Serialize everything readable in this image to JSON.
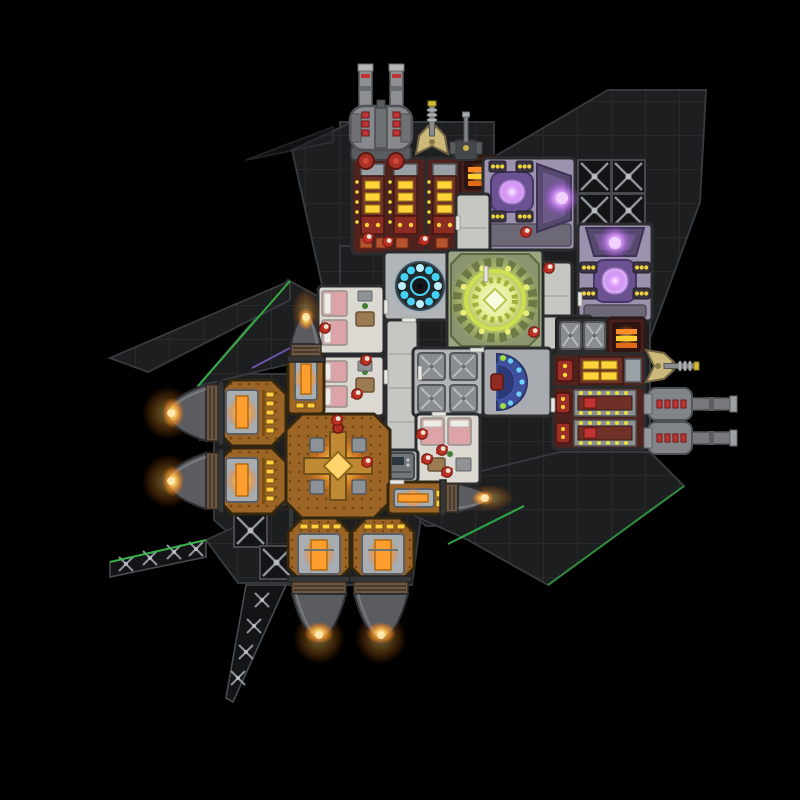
{
  "meta": {
    "app": "spaceship-builder-game",
    "view": "top-down-ship-blueprint"
  },
  "scene": {
    "width": 800,
    "height": 800,
    "background": "#000000"
  },
  "palette": {
    "hull": "#1d1e20",
    "hullLine": "#303336",
    "truss": "#131416",
    "trussStrut": "#8e949a",
    "corridor": "#c6c6c2",
    "roomFloor": "#b2b5b7",
    "wall": "#2b2c2d",
    "quartersFloor": "#dcd9d3",
    "bed": "#dca4a8",
    "ammoFloor": "#4f221d",
    "machineYellow": "#ffd43a",
    "loaderRed": "#9c2f26",
    "shieldFloor": "#9d92ad",
    "shieldPurple": "#c36cf0",
    "reactorGreenFloor": "#9aa582",
    "reactorGreen": "#cde04e",
    "reactorBlue": "#45d2f4",
    "controlBlue": "#3e4f9e",
    "controlGlow": "#6fd2f4",
    "engineFloor": "#9c6526",
    "engineGlow": "#ff9d2e",
    "lightStrip": "#ffcf3e",
    "flame": "#ff9a2e",
    "gunGray": "#85888b",
    "gunRed": "#c23434",
    "turretTan": "#cdb97a",
    "crewBody": "#bf3226",
    "crewHead": "#e9e3d5",
    "accentGreen": "#36c24a",
    "accentPurple": "#7a5cc4"
  },
  "hull": {
    "plates": [
      {
        "name": "hull-top-strip",
        "pts": [
          [
            340,
            122
          ],
          [
            494,
            122
          ],
          [
            494,
            160
          ],
          [
            340,
            160
          ]
        ]
      },
      {
        "name": "hull-left-sliver",
        "pts": [
          [
            292,
            150
          ],
          [
            352,
            122
          ],
          [
            352,
            348
          ],
          [
            332,
            348
          ],
          [
            332,
            330
          ]
        ]
      },
      {
        "name": "hull-top-right",
        "pts": [
          [
            492,
            158
          ],
          [
            608,
            90
          ],
          [
            706,
            90
          ],
          [
            700,
            202
          ],
          [
            645,
            352
          ],
          [
            556,
            352
          ],
          [
            492,
            250
          ]
        ]
      },
      {
        "name": "hull-central",
        "pts": [
          [
            340,
            246
          ],
          [
            456,
            246
          ],
          [
            456,
            188
          ],
          [
            494,
            188
          ],
          [
            494,
            246
          ],
          [
            650,
            246
          ],
          [
            650,
            462
          ],
          [
            562,
            462
          ],
          [
            470,
            526
          ],
          [
            426,
            526
          ],
          [
            384,
            490
          ],
          [
            384,
            462
          ],
          [
            340,
            462
          ]
        ]
      },
      {
        "name": "hull-engine-block",
        "pts": [
          [
            214,
            374
          ],
          [
            420,
            374
          ],
          [
            420,
            524
          ],
          [
            412,
            585
          ],
          [
            288,
            585
          ],
          [
            214,
            520
          ]
        ]
      },
      {
        "name": "hull-wing-right",
        "pts": [
          [
            415,
            487
          ],
          [
            560,
            452
          ],
          [
            650,
            452
          ],
          [
            684,
            486
          ],
          [
            548,
            585
          ],
          [
            468,
            540
          ],
          [
            415,
            516
          ]
        ]
      },
      {
        "name": "hull-wing-left",
        "pts": [
          [
            288,
            280
          ],
          [
            347,
            312
          ],
          [
            347,
            350
          ],
          [
            198,
            386
          ]
        ]
      },
      {
        "name": "hull-spike-left",
        "pts": [
          [
            110,
            358
          ],
          [
            290,
            281
          ],
          [
            290,
            300
          ],
          [
            148,
            372
          ]
        ]
      },
      {
        "name": "hull-wing-bl",
        "pts": [
          [
            206,
            540
          ],
          [
            290,
            502
          ],
          [
            290,
            583
          ],
          [
            238,
            583
          ]
        ]
      },
      {
        "name": "hull-arrow-bl",
        "pts": [
          [
            292,
            502
          ],
          [
            352,
            468
          ],
          [
            352,
            504
          ],
          [
            292,
            542
          ]
        ]
      },
      {
        "name": "mount-plate",
        "pts": [
          [
            200,
            392
          ],
          [
            218,
            392
          ],
          [
            218,
            440
          ],
          [
            200,
            440
          ]
        ]
      },
      {
        "name": "mount-plate",
        "pts": [
          [
            200,
            458
          ],
          [
            218,
            458
          ],
          [
            218,
            506
          ],
          [
            200,
            506
          ]
        ]
      },
      {
        "name": "hull-sliver-tl",
        "pts": [
          [
            246,
            160
          ],
          [
            333,
            127
          ],
          [
            333,
            142
          ]
        ],
        "faint": true
      }
    ],
    "girders": [
      {
        "name": "truss-girder-left",
        "pts": [
          [
            110,
            562
          ],
          [
            206,
            540
          ],
          [
            206,
            557
          ],
          [
            110,
            577
          ]
        ],
        "crosses": [
          [
            126,
            564
          ],
          [
            150,
            558
          ],
          [
            174,
            552
          ],
          [
            196,
            549
          ]
        ]
      },
      {
        "name": "truss-girder-down",
        "pts": [
          [
            246,
            585
          ],
          [
            286,
            585
          ],
          [
            233,
            702
          ],
          [
            226,
            698
          ]
        ],
        "crosses": [
          [
            262,
            600
          ],
          [
            254,
            626
          ],
          [
            246,
            652
          ],
          [
            238,
            678
          ]
        ]
      }
    ],
    "trussTiles": [
      [
        578,
        160
      ],
      [
        612,
        160
      ],
      [
        578,
        194
      ],
      [
        612,
        194
      ],
      [
        544,
        194
      ],
      [
        234,
        514
      ],
      [
        260,
        546
      ]
    ],
    "accents": [
      {
        "x1": 198,
        "y1": 386,
        "x2": 290,
        "y2": 281,
        "c": "#36c24a"
      },
      {
        "x1": 110,
        "y1": 562,
        "x2": 206,
        "y2": 540,
        "c": "#36c24a"
      },
      {
        "x1": 448,
        "y1": 544,
        "x2": 524,
        "y2": 506,
        "c": "#36c24a"
      },
      {
        "x1": 548,
        "y1": 585,
        "x2": 684,
        "y2": 486,
        "c": "#2f9e3e"
      },
      {
        "x1": 252,
        "y1": 368,
        "x2": 290,
        "y2": 348,
        "c": "#7a5cc4"
      }
    ]
  },
  "rooms": [
    {
      "name": "ammo-factory-large",
      "type": "ammo2",
      "x": 352,
      "y": 158,
      "w": 74,
      "h": 96
    },
    {
      "name": "ammo-factory-small",
      "type": "ammo1",
      "x": 426,
      "y": 158,
      "w": 36,
      "h": 96
    },
    {
      "name": "vent-box",
      "type": "vent",
      "x": 460,
      "y": 156,
      "w": 37,
      "h": 38
    },
    {
      "name": "shield-generator",
      "type": "shieldH",
      "x": 483,
      "y": 158,
      "w": 92,
      "h": 92
    },
    {
      "name": "shield-generator",
      "type": "shieldV",
      "x": 578,
      "y": 224,
      "w": 74,
      "h": 97
    },
    {
      "name": "corridor",
      "type": "corr",
      "x": 456,
      "y": 194,
      "w": 34,
      "h": 100
    },
    {
      "name": "corridor",
      "type": "corr",
      "x": 486,
      "y": 258,
      "w": 56,
      "h": 36
    },
    {
      "name": "corridor",
      "type": "corr",
      "x": 540,
      "y": 262,
      "w": 32,
      "h": 88
    },
    {
      "name": "corridor",
      "type": "corr",
      "x": 540,
      "y": 316,
      "w": 52,
      "h": 34
    },
    {
      "name": "reactor-small",
      "type": "reactorS",
      "x": 384,
      "y": 252,
      "w": 72,
      "h": 68
    },
    {
      "name": "reactor-large",
      "type": "reactorL",
      "x": 447,
      "y": 250,
      "w": 96,
      "h": 100
    },
    {
      "name": "crew-quarters",
      "type": "quartersH",
      "x": 318,
      "y": 286,
      "w": 66,
      "h": 68
    },
    {
      "name": "crew-quarters",
      "type": "quartersH",
      "x": 318,
      "y": 356,
      "w": 66,
      "h": 60
    },
    {
      "name": "corridor",
      "type": "corr",
      "x": 386,
      "y": 320,
      "w": 32,
      "h": 162
    },
    {
      "name": "storage-room",
      "type": "storage",
      "x": 413,
      "y": 348,
      "w": 70,
      "h": 68
    },
    {
      "name": "control-room",
      "type": "control",
      "x": 483,
      "y": 348,
      "w": 68,
      "h": 68
    },
    {
      "name": "crate-stack",
      "type": "storage2",
      "x": 556,
      "y": 318,
      "w": 52,
      "h": 36
    },
    {
      "name": "vent-box",
      "type": "vent",
      "x": 608,
      "y": 318,
      "w": 37,
      "h": 38
    },
    {
      "name": "ammo-machine-row",
      "type": "ammoRow1",
      "x": 553,
      "y": 354,
      "w": 92,
      "h": 33
    },
    {
      "name": "ammo-factory-right",
      "type": "ammoRow2",
      "x": 553,
      "y": 387,
      "w": 92,
      "h": 62
    },
    {
      "name": "crew-quarters",
      "type": "quartersV",
      "x": 416,
      "y": 414,
      "w": 64,
      "h": 70
    },
    {
      "name": "console-room",
      "type": "console",
      "x": 384,
      "y": 450,
      "w": 34,
      "h": 32
    },
    {
      "name": "engine-room",
      "type": "engine",
      "x": 218,
      "y": 380,
      "w": 68,
      "h": 66,
      "side": "left"
    },
    {
      "name": "engine-room",
      "type": "engine",
      "x": 218,
      "y": 448,
      "w": 68,
      "h": 66,
      "side": "left"
    },
    {
      "name": "engine-room-large",
      "type": "engineL",
      "x": 286,
      "y": 414,
      "w": 104,
      "h": 104
    },
    {
      "name": "thruster-housing",
      "type": "engineS",
      "x": 288,
      "y": 354,
      "w": 36,
      "h": 60
    },
    {
      "name": "thruster-housing",
      "type": "engineS2",
      "x": 388,
      "y": 482,
      "w": 58,
      "h": 32
    },
    {
      "name": "engine-room",
      "type": "engine",
      "x": 288,
      "y": 518,
      "w": 62,
      "h": 64,
      "side": "down"
    },
    {
      "name": "engine-room",
      "type": "engine",
      "x": 352,
      "y": 518,
      "w": 62,
      "h": 64,
      "side": "down"
    }
  ],
  "doors": [
    [
      456,
      216,
      4,
      14
    ],
    [
      484,
      266,
      4,
      16
    ],
    [
      578,
      292,
      4,
      14
    ],
    [
      418,
      366,
      4,
      14
    ],
    [
      384,
      300,
      4,
      14
    ],
    [
      384,
      370,
      4,
      14
    ],
    [
      432,
      412,
      14,
      4
    ],
    [
      402,
      318,
      14,
      4
    ],
    [
      470,
      348,
      14,
      4
    ],
    [
      551,
      398,
      4,
      14
    ],
    [
      390,
      480,
      14,
      4
    ]
  ],
  "weapons": [
    {
      "name": "heavy-cannon",
      "type": "cannonUp",
      "x": 381,
      "y": 120
    },
    {
      "name": "missile-turret",
      "type": "turretUp",
      "x": 432,
      "y": 134
    },
    {
      "name": "point-defense-gun",
      "type": "gunUp",
      "x": 466,
      "y": 140
    },
    {
      "name": "missile-turret",
      "type": "turretRight",
      "x": 666,
      "y": 366
    },
    {
      "name": "medium-cannon",
      "type": "cannonRight",
      "x": 672,
      "y": 404
    },
    {
      "name": "medium-cannon",
      "type": "cannonRight",
      "x": 672,
      "y": 438
    }
  ],
  "thrusters": [
    {
      "name": "thruster-left",
      "dir": "left",
      "x": 218,
      "y": 413,
      "len": 38,
      "g": 56
    },
    {
      "name": "thruster-left",
      "dir": "left",
      "x": 218,
      "y": 481,
      "len": 38,
      "g": 56
    },
    {
      "name": "thruster-up",
      "dir": "up",
      "x": 306,
      "y": 356,
      "len": 30,
      "g": 30
    },
    {
      "name": "thruster-right",
      "dir": "right",
      "x": 446,
      "y": 498,
      "len": 30,
      "g": 28
    },
    {
      "name": "thruster-down",
      "dir": "down",
      "x": 319,
      "y": 582,
      "len": 44,
      "g": 54
    },
    {
      "name": "thruster-down",
      "dir": "down",
      "x": 381,
      "y": 582,
      "len": 44,
      "g": 54
    }
  ],
  "crew": [
    [
      368,
      238
    ],
    [
      388,
      242
    ],
    [
      424,
      240
    ],
    [
      526,
      232
    ],
    [
      549,
      268
    ],
    [
      534,
      332
    ],
    [
      325,
      328
    ],
    [
      366,
      360
    ],
    [
      357,
      394
    ],
    [
      422,
      434
    ],
    [
      442,
      450
    ],
    [
      427,
      459
    ],
    [
      447,
      472
    ],
    [
      367,
      462
    ],
    [
      337,
      420
    ]
  ]
}
